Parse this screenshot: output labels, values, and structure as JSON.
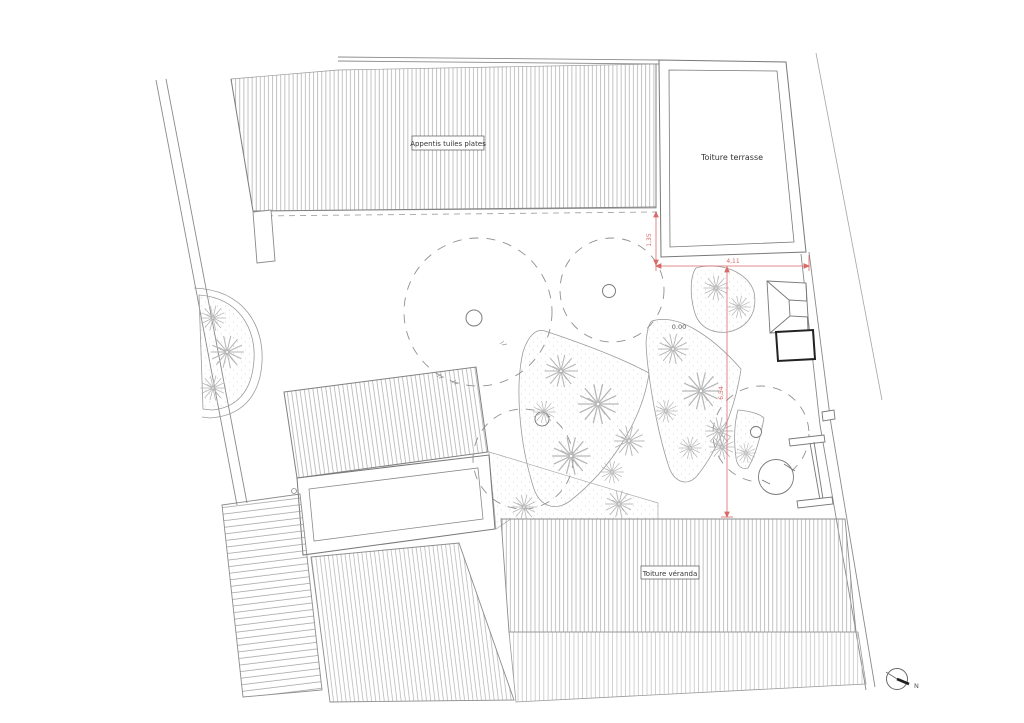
{
  "plan": {
    "labels": {
      "appentis": "Appentis tuiles plates",
      "terrasse": "Toiture terrasse",
      "veranda": "Toiture véranda",
      "level": "0.00",
      "north": "N"
    },
    "dimensions": {
      "terrasse_left": "1,35",
      "terrasse_bottom": "4,11",
      "garden_vertical": "6,54"
    },
    "colors": {
      "outline": "#787878",
      "hatch": "#a9a9a9",
      "dimension_red": "#d96a6a",
      "tree_sketch": "#b6b6b6",
      "shed_black": "#222222"
    }
  }
}
